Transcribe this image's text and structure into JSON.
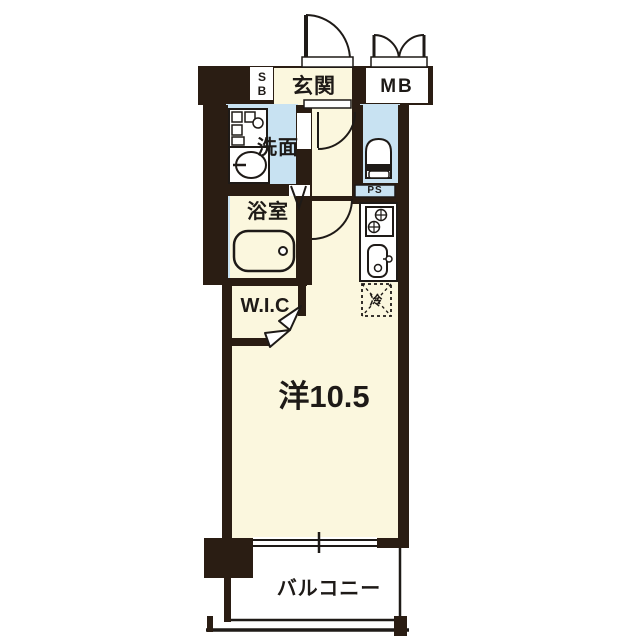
{
  "plan": {
    "title": "apartment-floor-plan",
    "rooms": {
      "entrance": "玄関",
      "meter_box": "MB",
      "shoe_box": "SB",
      "washroom": "洗面",
      "bathroom": "浴室",
      "pipe_space": "PS",
      "walk_in_closet": "W.I.C",
      "main_room": "洋10.5",
      "balcony": "バルコニー",
      "refrigerator": "冷"
    },
    "colors": {
      "wall": "#2a1d13",
      "room_cream": "#fbf7de",
      "wet_area_blue": "#c8e2f2",
      "fixture_white": "#ffffff",
      "line": "#1e1a17"
    }
  }
}
